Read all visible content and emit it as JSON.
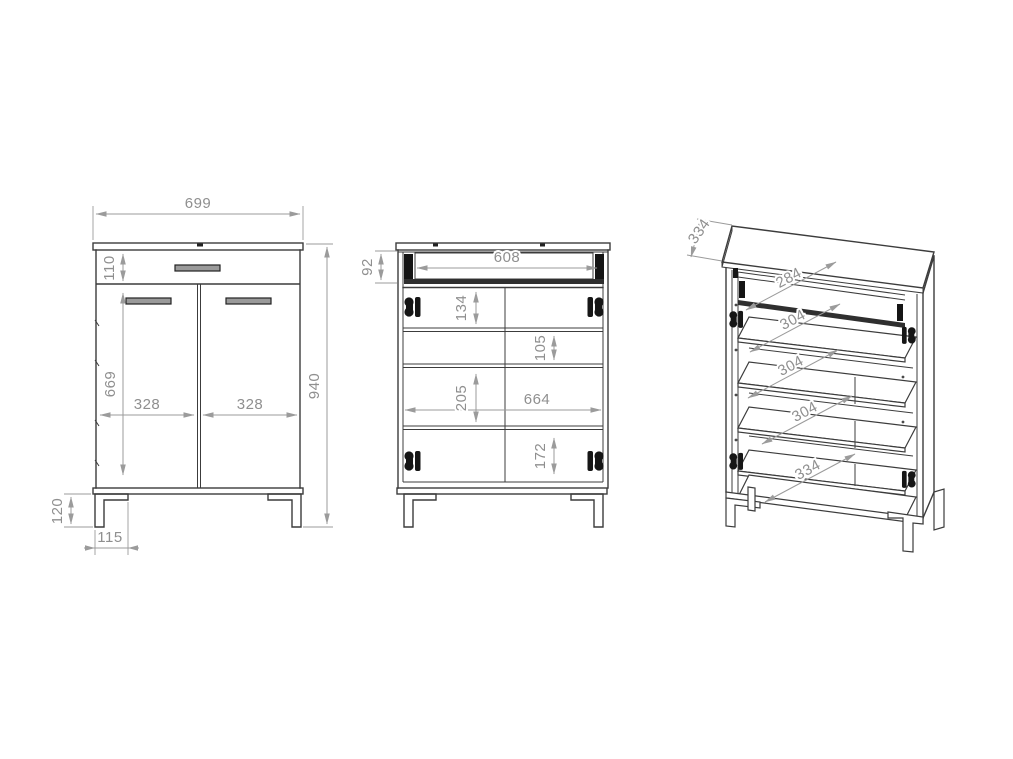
{
  "drawing": {
    "background": "#ffffff",
    "object_line_color": "#3c3c3c",
    "dimension_line_color": "#9b9b9b",
    "dimension_text_color": "#8f8f8f",
    "views": {
      "front": {
        "dims": {
          "overall_width": "699",
          "overall_height": "940",
          "drawer_front_height": "110",
          "door_height": "669",
          "left_door_width": "328",
          "right_door_width": "328",
          "leg_height": "120",
          "leg_bracket_depth": "115"
        }
      },
      "open": {
        "dims": {
          "drawer_box_height": "92",
          "drawer_inner_width": "608",
          "top_gap": "134",
          "second_gap": "105",
          "third_gap": "205",
          "interior_width": "664",
          "bottom_gap": "172"
        }
      },
      "iso": {
        "dims": {
          "overall_depth": "334",
          "drawer_shelf_depth": "284",
          "upper_shelf_depth": "304",
          "middle_shelf_depth": "304",
          "lower_shelf_depth": "304",
          "bottom_shelf_depth": "334"
        }
      }
    }
  }
}
